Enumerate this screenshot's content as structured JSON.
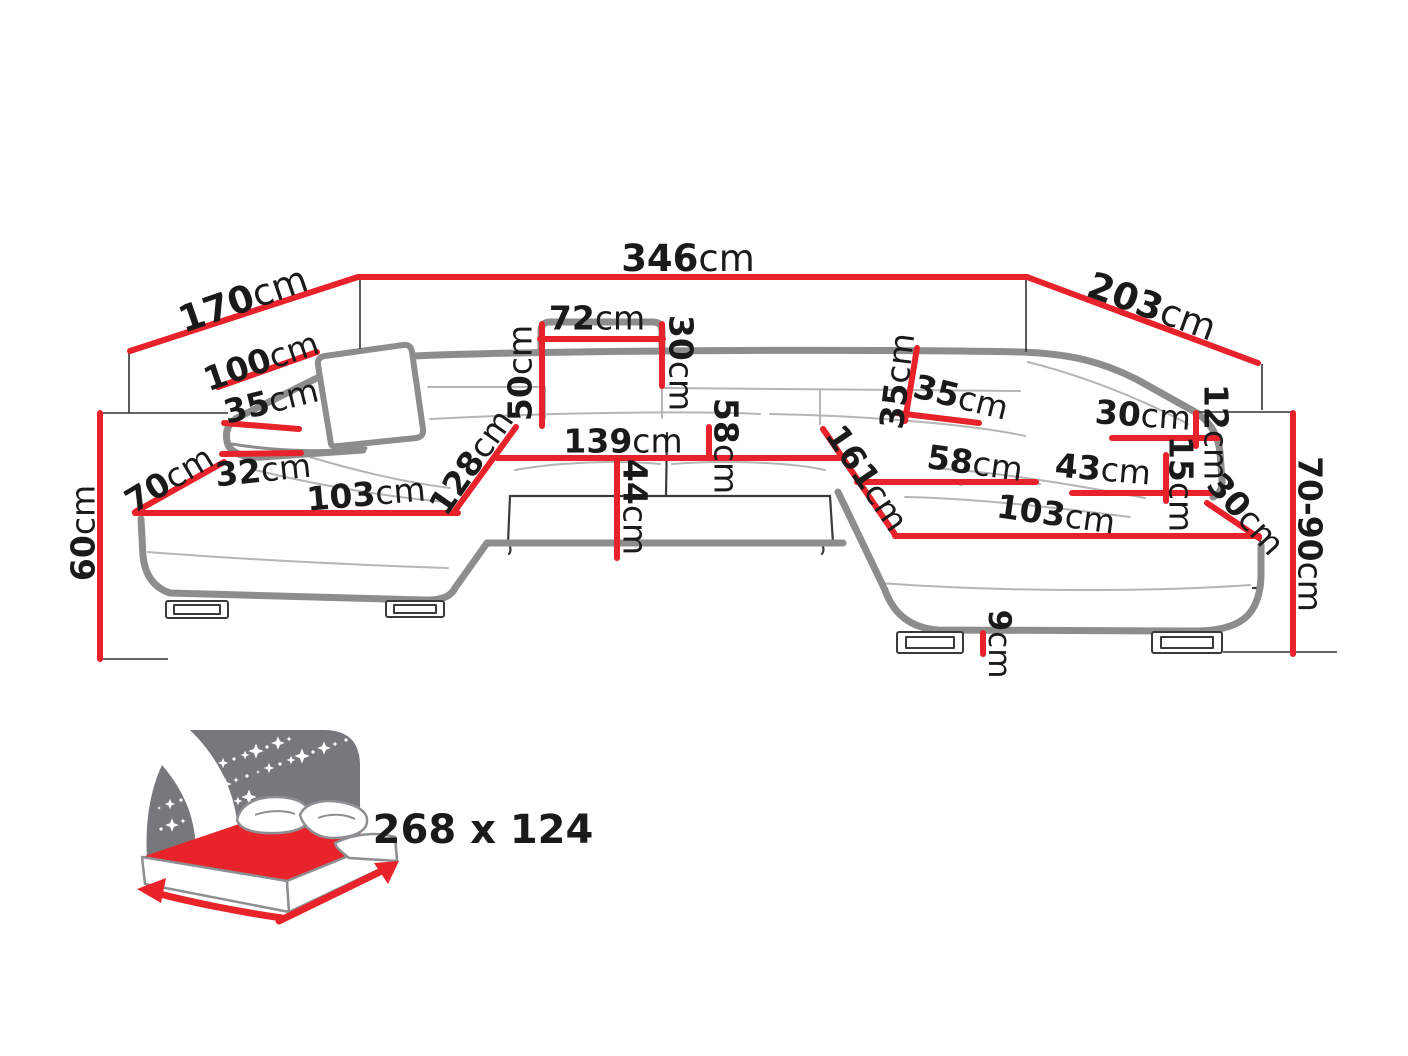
{
  "diagram": {
    "type": "furniture-dimension-diagram",
    "product": "u-shaped-corner-sofa",
    "colors": {
      "dimension_red": "#e8222a",
      "label_black": "#1a1a1a",
      "sofa_outline_gray": "#8d8d8d",
      "icon_panel_gray": "#77787b",
      "icon_text_gray": "#6d6e70",
      "mattress_red": "#e8232a"
    },
    "dims": {
      "d346": {
        "value": "346",
        "unit": "cm"
      },
      "d170": {
        "value": "170",
        "unit": "cm"
      },
      "d203": {
        "value": "203",
        "unit": "cm"
      },
      "d100": {
        "value": "100",
        "unit": "cm"
      },
      "d35_left": {
        "value": "35",
        "unit": "cm"
      },
      "d70": {
        "value": "70",
        "unit": "cm"
      },
      "d32": {
        "value": "32",
        "unit": "cm"
      },
      "d103_left": {
        "value": "103",
        "unit": "cm"
      },
      "d128": {
        "value": "128",
        "unit": "cm"
      },
      "d50": {
        "value": "50",
        "unit": "cm"
      },
      "d72": {
        "value": "72",
        "unit": "cm"
      },
      "d30_back": {
        "value": "30",
        "unit": "cm"
      },
      "d139": {
        "value": "139",
        "unit": "cm"
      },
      "d58_center": {
        "value": "58",
        "unit": "cm"
      },
      "d44": {
        "value": "44",
        "unit": "cm"
      },
      "d161": {
        "value": "161",
        "unit": "cm"
      },
      "d35_right_back": {
        "value": "35",
        "unit": "cm"
      },
      "d35_right_top": {
        "value": "35",
        "unit": "cm"
      },
      "d58_right": {
        "value": "58",
        "unit": "cm"
      },
      "d103_right": {
        "value": "103",
        "unit": "cm"
      },
      "d43": {
        "value": "43",
        "unit": "cm"
      },
      "d30_right_arm": {
        "value": "30",
        "unit": "cm"
      },
      "d12": {
        "value": "12",
        "unit": "cm"
      },
      "d15": {
        "value": "15",
        "unit": "cm"
      },
      "d30_right_corner": {
        "value": "30",
        "unit": "cm"
      },
      "d70_90": {
        "value": "70-90",
        "unit": "cm"
      },
      "d60": {
        "value": "60",
        "unit": "cm"
      },
      "d9": {
        "value": "9",
        "unit": "cm"
      }
    },
    "sleeping_area": {
      "label": "268 x 124"
    }
  }
}
